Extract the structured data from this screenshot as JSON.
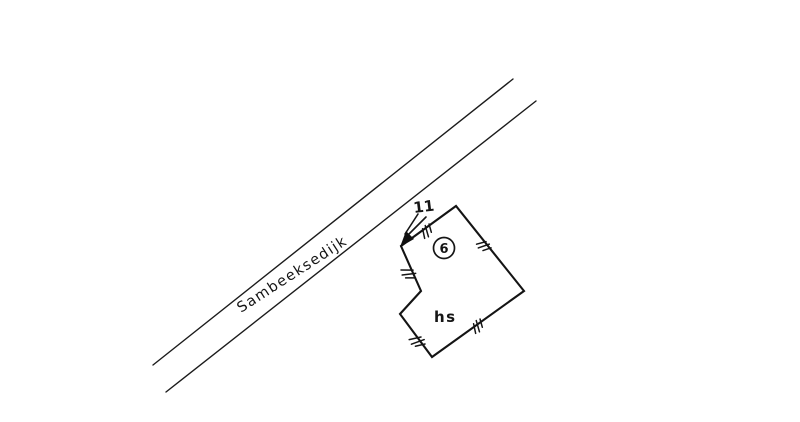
{
  "colors": {
    "paper": "#ffffff",
    "ink": "#1b1b1b"
  },
  "labels": {
    "road_name": "Sambeeksedijk",
    "parcel_number": "6",
    "building_use": "hs",
    "house_number": "11"
  }
}
